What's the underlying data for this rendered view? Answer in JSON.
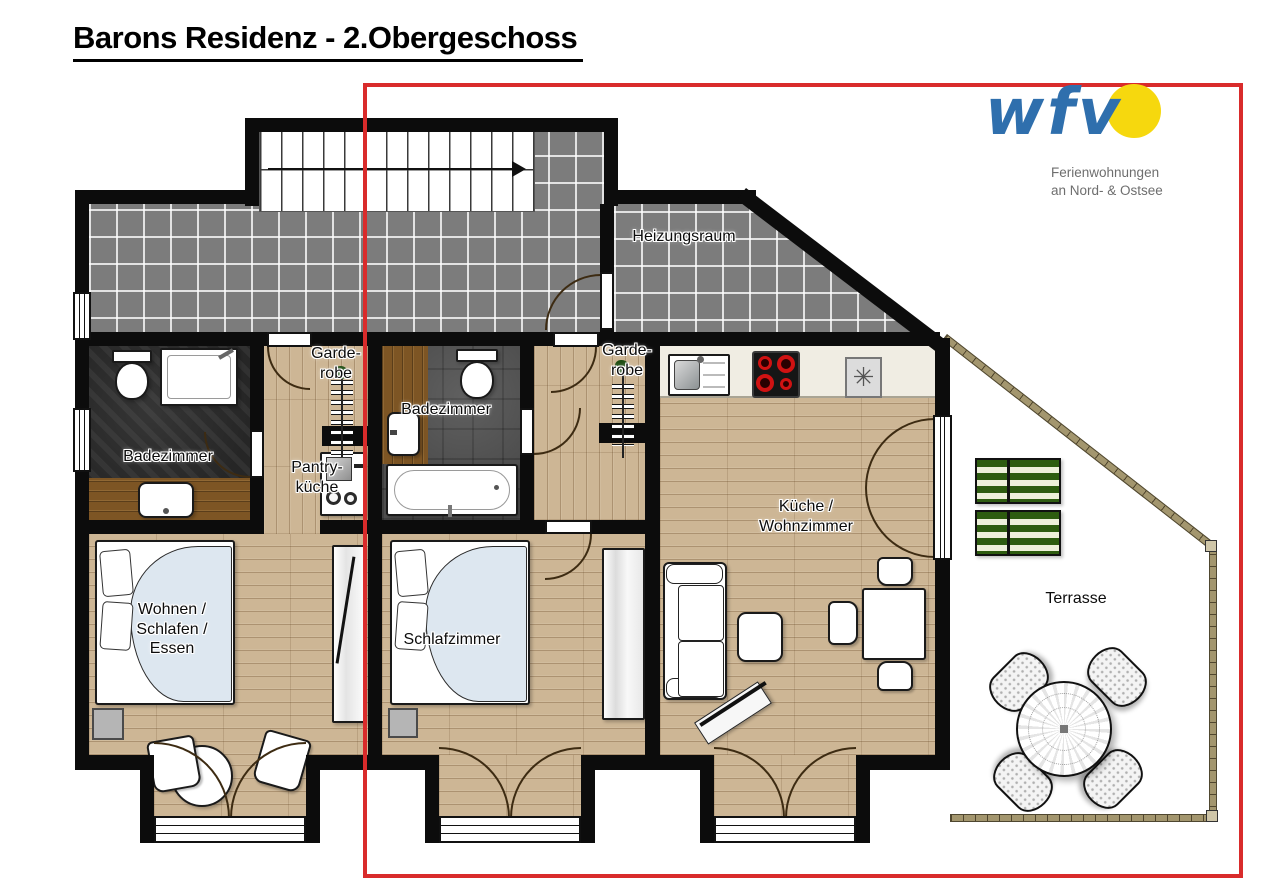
{
  "title": "Barons Residenz - 2.Obergeschoss",
  "logo": {
    "name": "wfv",
    "tagline": "Ferienwohnungen\nan Nord- & Ostsee"
  },
  "rooms": {
    "heizungsraum": "Heizungsraum",
    "garderobe_left": "Garde-\nrobe",
    "garderobe_right": "Garde-\nrobe",
    "badezimmer_left": "Badezimmer",
    "badezimmer_middle": "Badezimmer",
    "pantrykueche": "Pantry-\nküche",
    "wohnen_schlafen_essen": "Wohnen /\nSchlafen /\nEssen",
    "schlafzimmer": "Schlafzimmer",
    "kueche_wohnzimmer": "Küche /\nWohnzimmer",
    "terrasse": "Terrasse"
  },
  "symbols": {
    "appliance_star": "✳"
  },
  "colors": {
    "highlight_red": "#d92b2b",
    "logo_blue": "#2f6fad",
    "logo_sun": "#f6d80e",
    "tagline_gray": "#6e6e6e",
    "wall_black": "#0c0c0c",
    "tile_gray": "#7c7c7c",
    "wood_floor": "#cdb695",
    "bath_dark": "#262626",
    "bath_mid": "#4e4e4e",
    "railing_tan": "#a3966e",
    "lounger_green": "#2e5c10"
  }
}
